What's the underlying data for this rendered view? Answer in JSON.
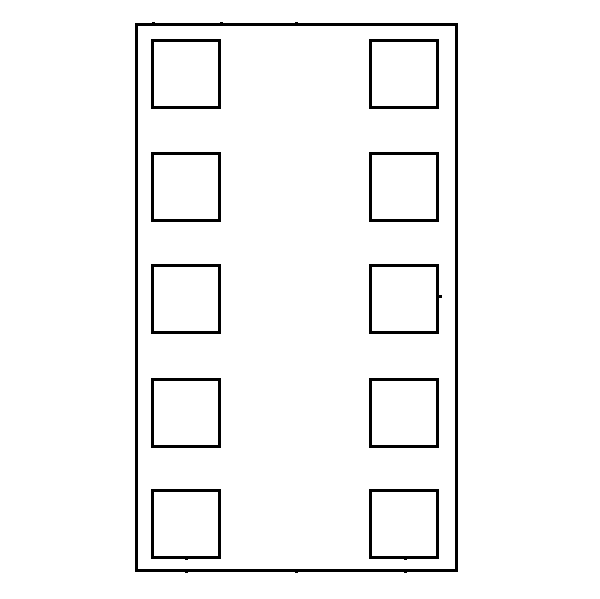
{
  "figure": {
    "kind": "package-outline-diagram",
    "description": "Outline drawing of a 10-pad dual-flat-no-lead style component: outer body rectangle with two vertical columns of five square pads",
    "background_color": "#ffffff",
    "line_color": "#000000",
    "body": {
      "x": 135,
      "y": 23,
      "width": 323,
      "height": 549,
      "stroke_px": 3
    },
    "pads": {
      "size_px": 70,
      "stroke_px": 3,
      "count": 10,
      "columns": [
        {
          "name": "left",
          "x": 151
        },
        {
          "name": "right",
          "x": 369
        }
      ],
      "row_tops": [
        39,
        152,
        264,
        378,
        489
      ]
    },
    "tick_marks": {
      "size_px": 3,
      "points": [
        {
          "name": "tick-top-pad-left-edge",
          "x": 153,
          "y": 23
        },
        {
          "name": "tick-top-pad-right-edge",
          "x": 221,
          "y": 23
        },
        {
          "name": "tick-top-centerline",
          "x": 296,
          "y": 23
        },
        {
          "name": "tick-left-edge-upper",
          "x": 136,
          "y": 185
        },
        {
          "name": "tick-left-pad-edge-upper",
          "x": 152,
          "y": 185
        },
        {
          "name": "tick-left-edge-center",
          "x": 136,
          "y": 296
        },
        {
          "name": "tick-left-edge-lower",
          "x": 136,
          "y": 474
        },
        {
          "name": "tick-left-edge-bottom",
          "x": 136,
          "y": 560
        },
        {
          "name": "tick-right-pad-edge-center",
          "x": 440,
          "y": 296
        },
        {
          "name": "tick-pad-left-bottom-center",
          "x": 186,
          "y": 558
        },
        {
          "name": "tick-pad-right-bottom-center",
          "x": 405,
          "y": 558
        },
        {
          "name": "tick-bottom-left-pad-center",
          "x": 186,
          "y": 571
        },
        {
          "name": "tick-bottom-centerline",
          "x": 296,
          "y": 571
        },
        {
          "name": "tick-bottom-right-pad-center",
          "x": 405,
          "y": 571
        }
      ]
    }
  }
}
